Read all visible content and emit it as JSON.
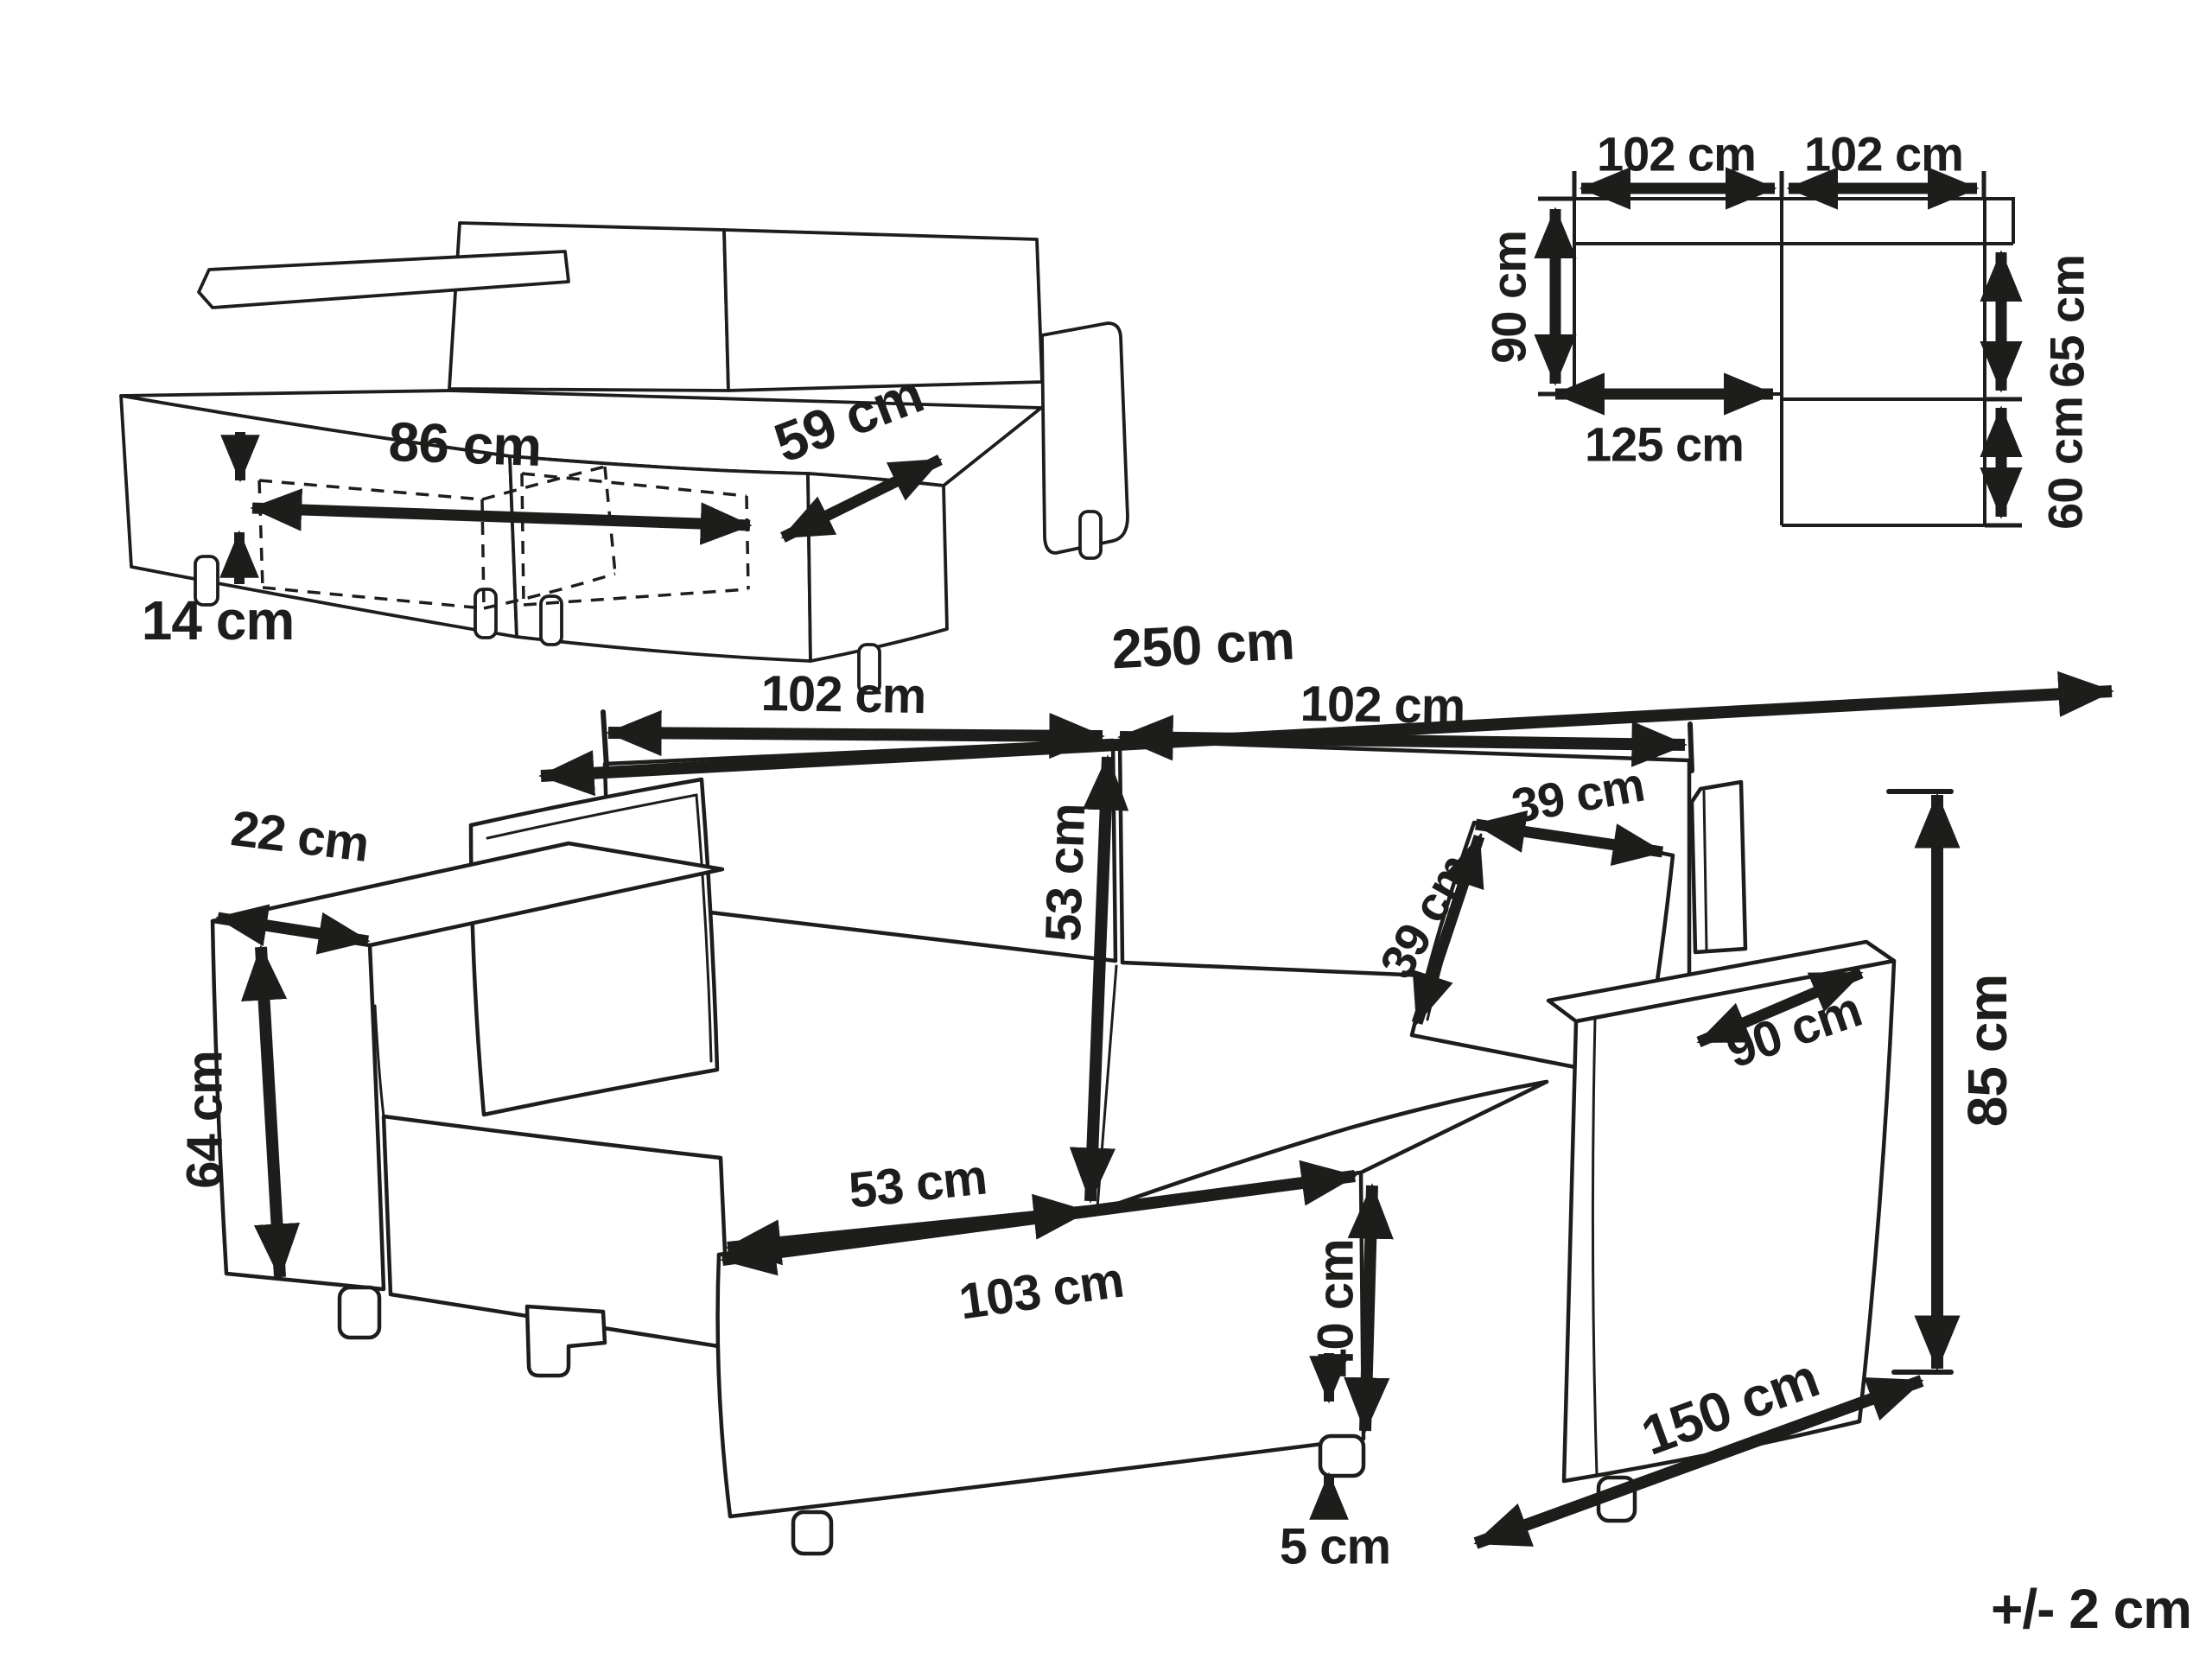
{
  "page": {
    "tolerance_note": "+/- 2 cm",
    "unit": "cm"
  },
  "colors": {
    "ink": "#1d1d1b",
    "paper": "#ffffff"
  },
  "storage_sketch": {
    "description": "isometric sofa sketch with hidden storage compartment shown dashed",
    "dims": {
      "width": "86 cm",
      "depth": "59 cm",
      "clearance": "14 cm"
    }
  },
  "floor_plan": {
    "description": "top view L-shaped footprint",
    "dims": {
      "left_width": "102 cm",
      "right_width": "102 cm",
      "left_depth": "90 cm",
      "bed_length": "125 cm",
      "upper_right_depth": "65 cm",
      "lower_right_depth": "60 cm"
    }
  },
  "front_view": {
    "description": "main perspective drawing of corner sofa with chaise",
    "dims": {
      "total_width": "250 cm",
      "left_section_width": "102 cm",
      "right_section_width": "102 cm",
      "backrest_height": "53 cm",
      "seat_depth": "53 cm",
      "chaise_length": "103 cm",
      "armrest_width": "22 cm",
      "armrest_height": "64 cm",
      "cushion_width": "39 cm",
      "cushion_height": "39 cm",
      "armrest_depth": "90 cm",
      "total_height": "85 cm",
      "seat_height": "40 cm",
      "leg_height": "5 cm",
      "total_depth": "150 cm"
    }
  }
}
